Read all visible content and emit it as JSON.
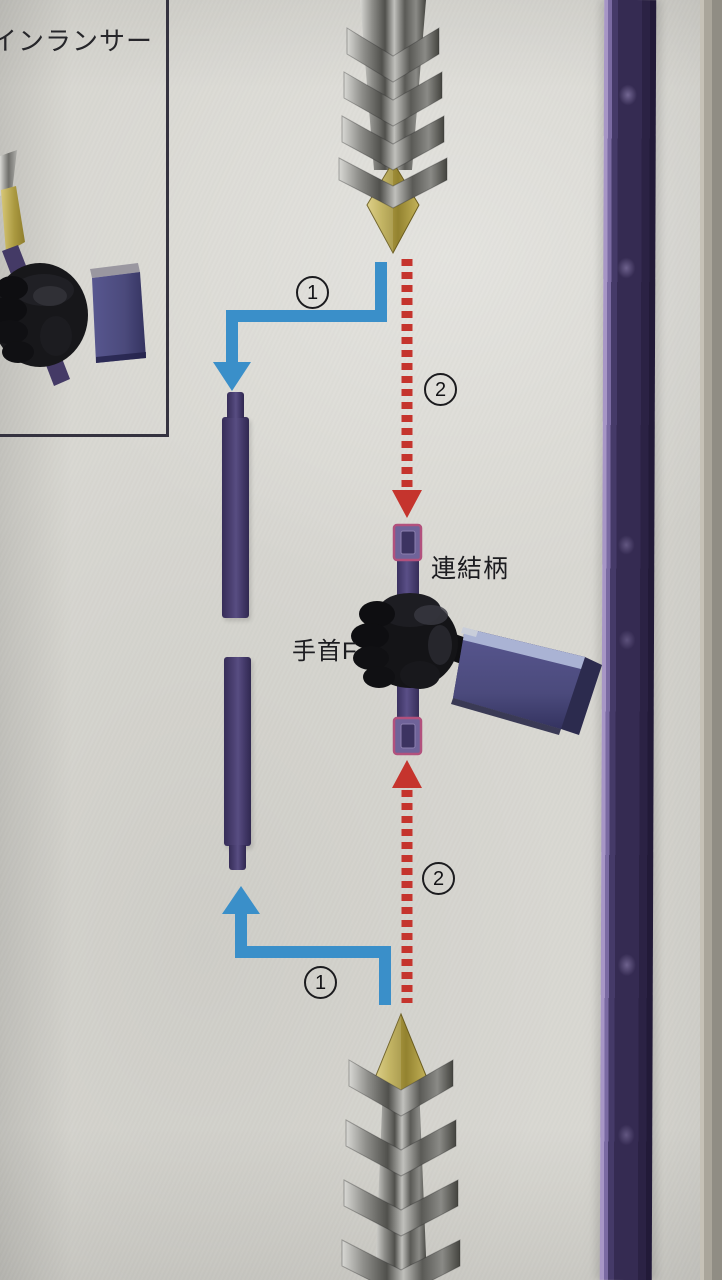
{
  "page": {
    "description": "Model kit instruction manual photo — twin lancer assembly step"
  },
  "inset": {
    "caption": "インランサー"
  },
  "labels": {
    "connector_handle": "連結柄",
    "wrist_f": "手首F"
  },
  "markers": {
    "step1": "1",
    "step2": "2"
  },
  "colors": {
    "paper": "#d9d8d2",
    "box_border": "#34323f",
    "arrow_blue": "#3a8fc9",
    "arrow_red": "#c5342d",
    "rod_purple": "#453a68",
    "connector_purple": "#5a4f87",
    "socket_pink": "#b2517d",
    "blade_silver": "#9b9b99",
    "blade_gold": "#b9a847",
    "hand_black": "#141417",
    "forearm_slate": "#4b4a7c",
    "forearm_stripe": "#aab3d4",
    "runner_purple": "#3b3158",
    "page_edge": "#908d84"
  }
}
